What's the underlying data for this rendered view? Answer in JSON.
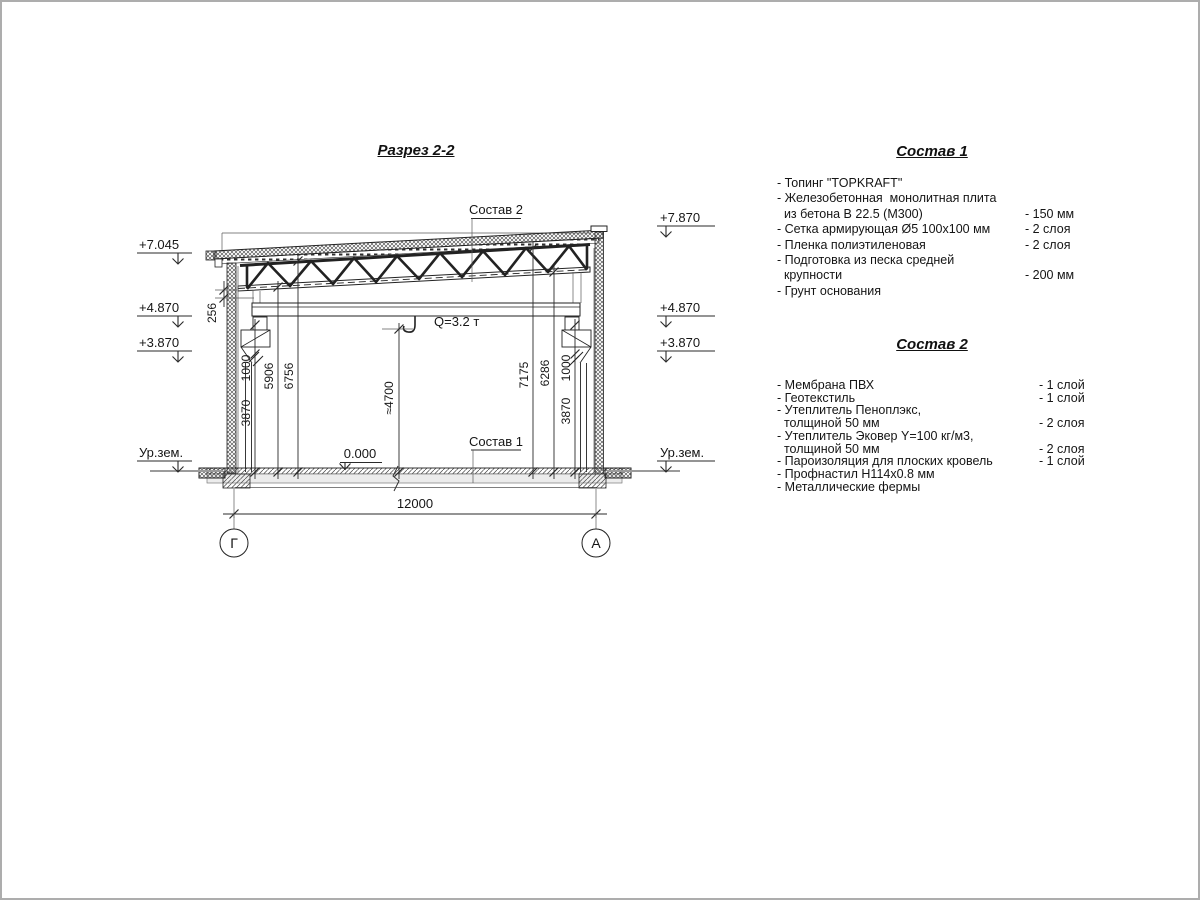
{
  "drawing": {
    "title": "Разрез 2-2",
    "callouts": {
      "roof": "Состав 2",
      "floor": "Состав 1"
    },
    "crane": "Q=3.2 т",
    "level_zero": "0.000",
    "elev_left": {
      "top": "+7.045",
      "mid": "+4.870",
      "low": "+3.870",
      "ground": "Ур.зем."
    },
    "elev_right": {
      "top": "+7.870",
      "mid": "+4.870",
      "low": "+3.870",
      "ground": "Ур.зем."
    },
    "dims": {
      "roof_256": "256",
      "left_3870": "3870",
      "left_1000": "1000",
      "left_5906": "5906",
      "left_6756": "6756",
      "hook": "≈4700",
      "right_7175": "7175",
      "right_6286": "6286",
      "right_1000": "1000",
      "right_3870": "3870",
      "span": "12000"
    },
    "axes": {
      "left": "Г",
      "right": "А"
    }
  },
  "spec1": {
    "title": "Состав 1",
    "rows": [
      {
        "text": "- Топинг \"TOPKRAFT\"",
        "value": ""
      },
      {
        "text": "- Железобетонная  монолитная плита",
        "value": ""
      },
      {
        "text": "  из бетона В 22.5 (М300)",
        "value": "- 150 мм"
      },
      {
        "text": "- Сетка армирующая Ø5 100x100 мм",
        "value": "- 2 слоя"
      },
      {
        "text": "- Пленка полиэтиленовая",
        "value": "- 2 слоя"
      },
      {
        "text": "- Подготовка из песка средней",
        "value": ""
      },
      {
        "text": "  крупности",
        "value": "- 200 мм"
      },
      {
        "text": "- Грунт основания",
        "value": ""
      }
    ]
  },
  "spec2": {
    "title": "Состав 2",
    "rows": [
      {
        "text": "- Мембрана ПВХ",
        "value": "- 1 слой"
      },
      {
        "text": "- Геотекстиль",
        "value": "- 1 слой"
      },
      {
        "text": "- Утеплитель Пеноплэкс,",
        "value": ""
      },
      {
        "text": "  толщиной 50 мм",
        "value": "- 2 слоя"
      },
      {
        "text": "- Утеплитель Эковер Y=100 кг/м3,",
        "value": ""
      },
      {
        "text": "  толщиной 50 мм",
        "value": "- 2 слоя"
      },
      {
        "text": "- Пароизоляция для плоских кровель",
        "value": "- 1 слой"
      },
      {
        "text": "- Профнастил Н114х0.8 мм",
        "value": ""
      },
      {
        "text": "- Металлические фермы",
        "value": ""
      }
    ]
  }
}
